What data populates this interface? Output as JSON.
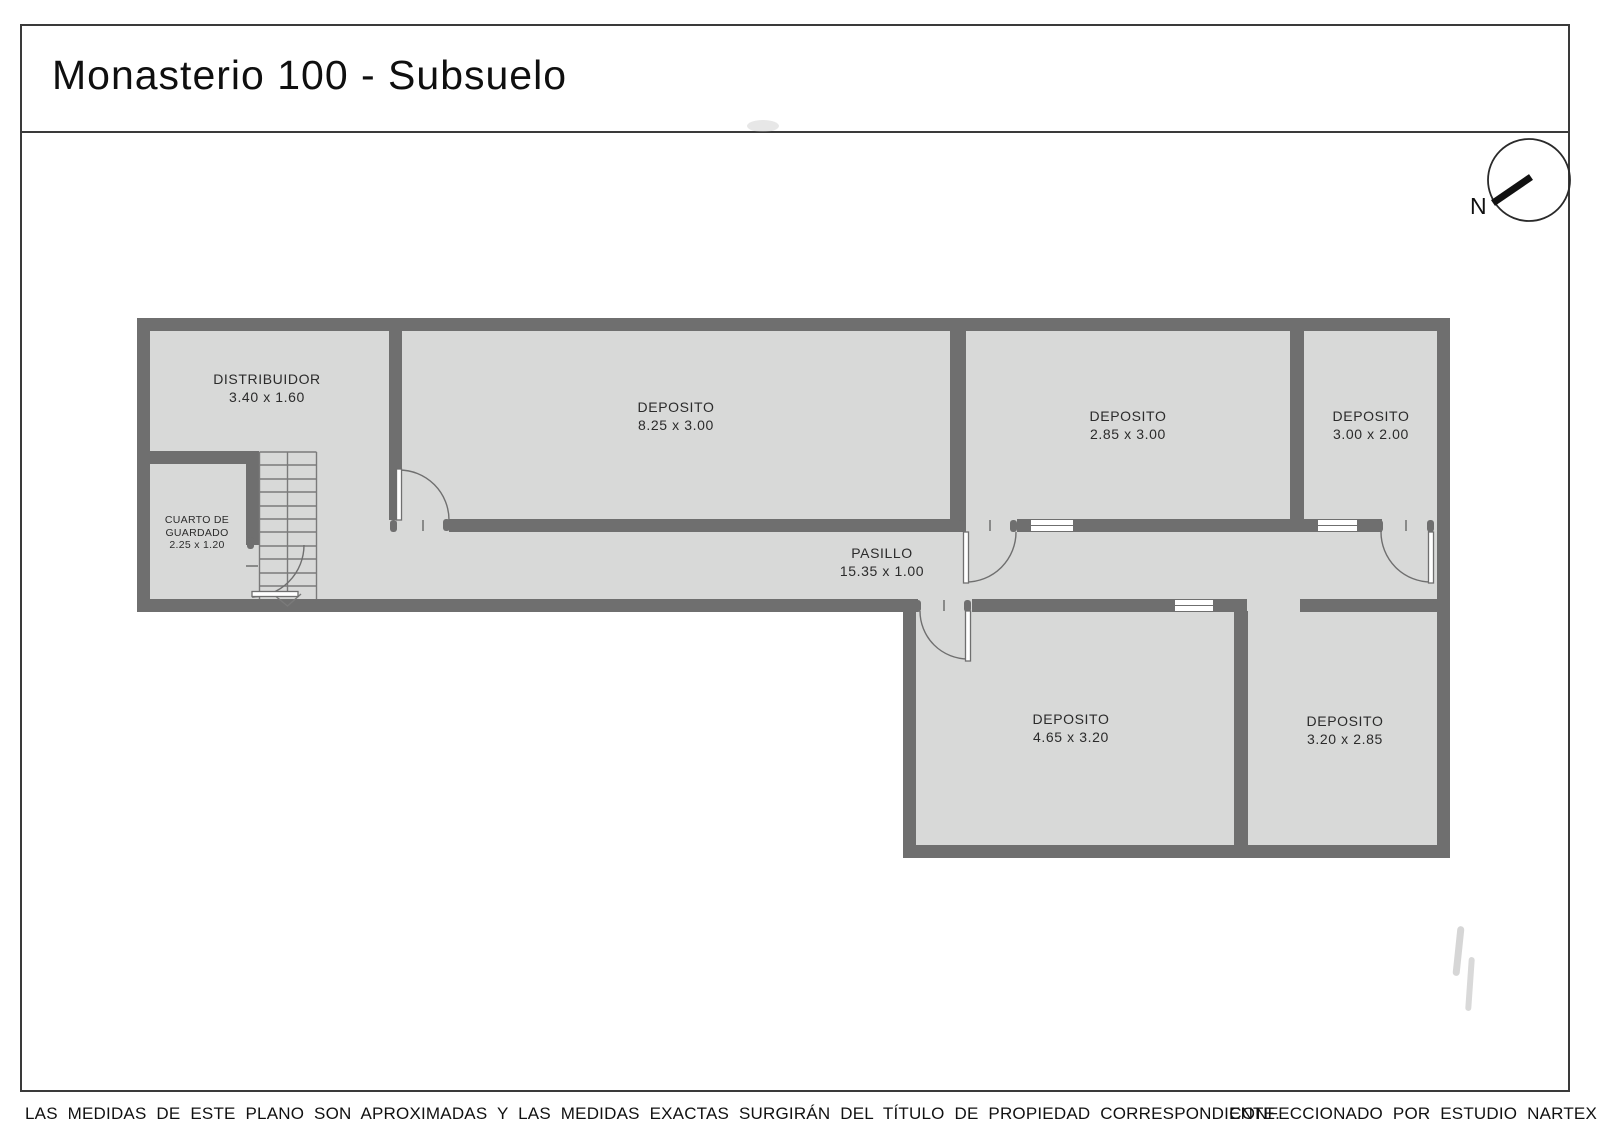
{
  "title": "Monasterio 100 - Subsuelo",
  "compass": {
    "label": "N"
  },
  "rooms": [
    {
      "id": "distribuidor",
      "name": "DISTRIBUIDOR",
      "dims": "3.40 x 1.60"
    },
    {
      "id": "cuarto-de-guardado",
      "name": "CUARTO DE",
      "name2": "GUARDADO",
      "dims": "2.25 x 1.20"
    },
    {
      "id": "deposito-1",
      "name": "DEPOSITO",
      "dims": "8.25 x 3.00"
    },
    {
      "id": "deposito-2",
      "name": "DEPOSITO",
      "dims": "2.85 x 3.00"
    },
    {
      "id": "deposito-3",
      "name": "DEPOSITO",
      "dims": "3.00 x 2.00"
    },
    {
      "id": "pasillo",
      "name": "PASILLO",
      "dims": "15.35 x 1.00"
    },
    {
      "id": "deposito-4",
      "name": "DEPOSITO",
      "dims": "4.65 x 3.20"
    },
    {
      "id": "deposito-5",
      "name": "DEPOSITO",
      "dims": "3.20 x 2.85"
    }
  ],
  "footer": {
    "disclaimer": "LAS MEDIDAS  DE ESTE PLANO SON APROXIMADAS Y LAS MEDIDAS EXACTAS SURGIRÁN DEL TÍTULO DE PROPIEDAD CORRESPONDIENTE.",
    "credit": "CONFECCIONADO POR ESTUDIO NARTEX"
  },
  "colors": {
    "wall": "#6f6f6f",
    "floor": "#d8d9d8",
    "frame": "#3a3a3a",
    "text": "#2b2b2b",
    "background": "#ffffff"
  }
}
